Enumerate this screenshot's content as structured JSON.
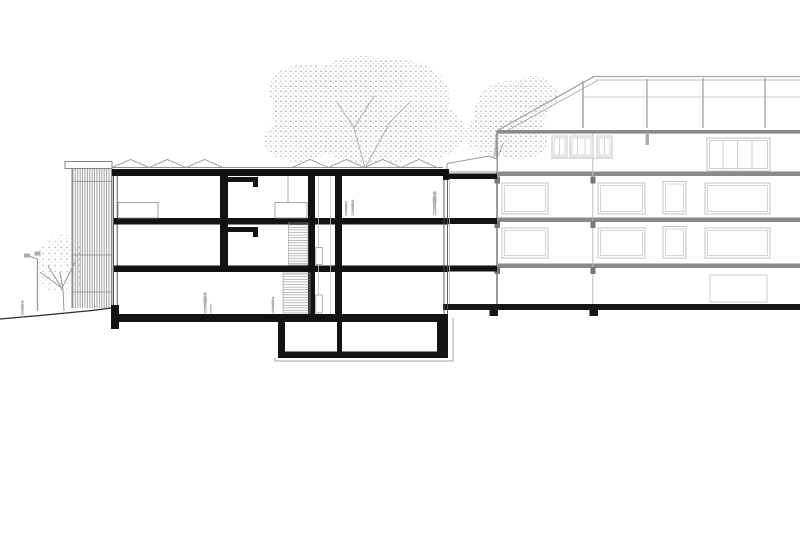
{
  "meta": {
    "title": "Architectural building cross-section drawing",
    "drawing_type": "section / elevation, black cut lines on white with gray background building",
    "background_color": "#ffffff"
  },
  "colors": {
    "cut_structure": "#121212",
    "ground_line": "#2b2b2b",
    "background_building_line": "#c4c4c4",
    "floor_band": "#8a8a8a",
    "column_stub": "#777777",
    "louver_line": "#777777",
    "stair_tread_line": "#8f8f8f",
    "foliage_stipple": "#ababab",
    "person_figure": "#b2b2b2",
    "skylight_outline": "#909090",
    "pergola_line": "#a8a8a8"
  },
  "cut_building": {
    "name": "sectioned school building",
    "floors_above_ground": 3,
    "has_basement": true,
    "louver_facade_side": "left",
    "roof_skylight_bumps_left_group": 3,
    "roof_skylight_bumps_right_group": 4,
    "stair_flights": 2,
    "interior_figures": 5,
    "link_slabs_to_neighbour": 3
  },
  "background_building": {
    "name": "adjacent building elevation",
    "floor_bands": 4,
    "roof_terrace_posts": 4,
    "window_rows": 3,
    "attic_small_window_units": 3,
    "has_sloped_roof_edge": true
  },
  "site": {
    "trees": 3,
    "street_lamp": true,
    "outdoor_figures": 1,
    "ground_slope": "falls gently to the left"
  }
}
